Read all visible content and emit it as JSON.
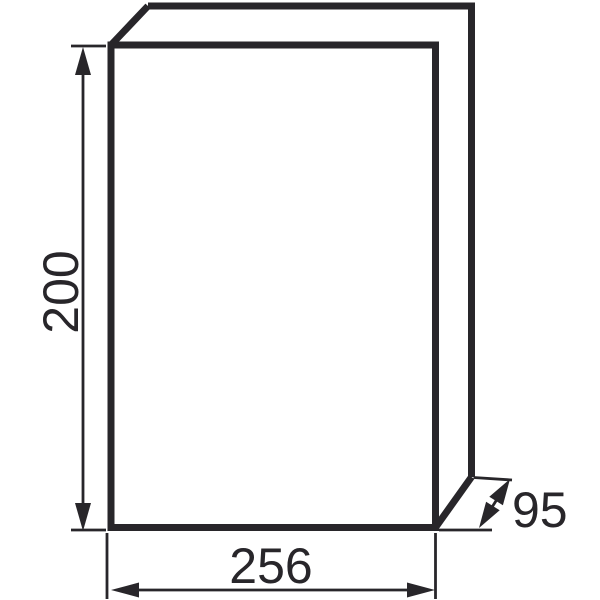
{
  "page": {
    "background_color": "#ffffff",
    "line_color": "#28262a"
  },
  "drawing": {
    "kind": "technical-dimension-drawing",
    "object": "rectangular enclosure box shown as oblique 3D outline",
    "dimensions": {
      "height": {
        "value": "200",
        "placement": "vertical dimension line on left side, label rotated 90deg"
      },
      "width": {
        "value": "256",
        "placement": "horizontal dimension line below box"
      },
      "depth": {
        "value": "95",
        "placement": "oblique double-headed arrow at bottom right"
      }
    }
  }
}
